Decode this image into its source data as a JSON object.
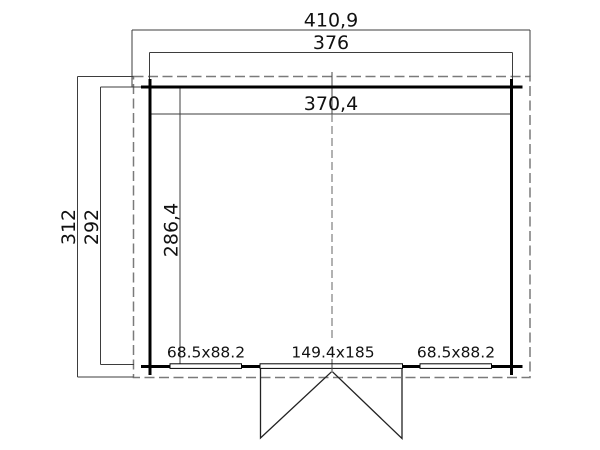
{
  "floorplan": {
    "dim_roof_width": "410,9",
    "dim_outer_width": "376",
    "dim_inner_width": "370,4",
    "dim_roof_depth": "312",
    "dim_outer_depth": "292",
    "dim_inner_depth": "286,4",
    "label_window_left": "68.5x88.2",
    "label_door": "149.4x185",
    "label_window_right": "68.5x88.2",
    "colors": {
      "wall": "#000000",
      "dimension_line": "#3d3d3d",
      "roof_outline_dash": "#7a7a7a",
      "center_line_dash": "#666666",
      "text": "#111111",
      "background": "#ffffff"
    }
  }
}
